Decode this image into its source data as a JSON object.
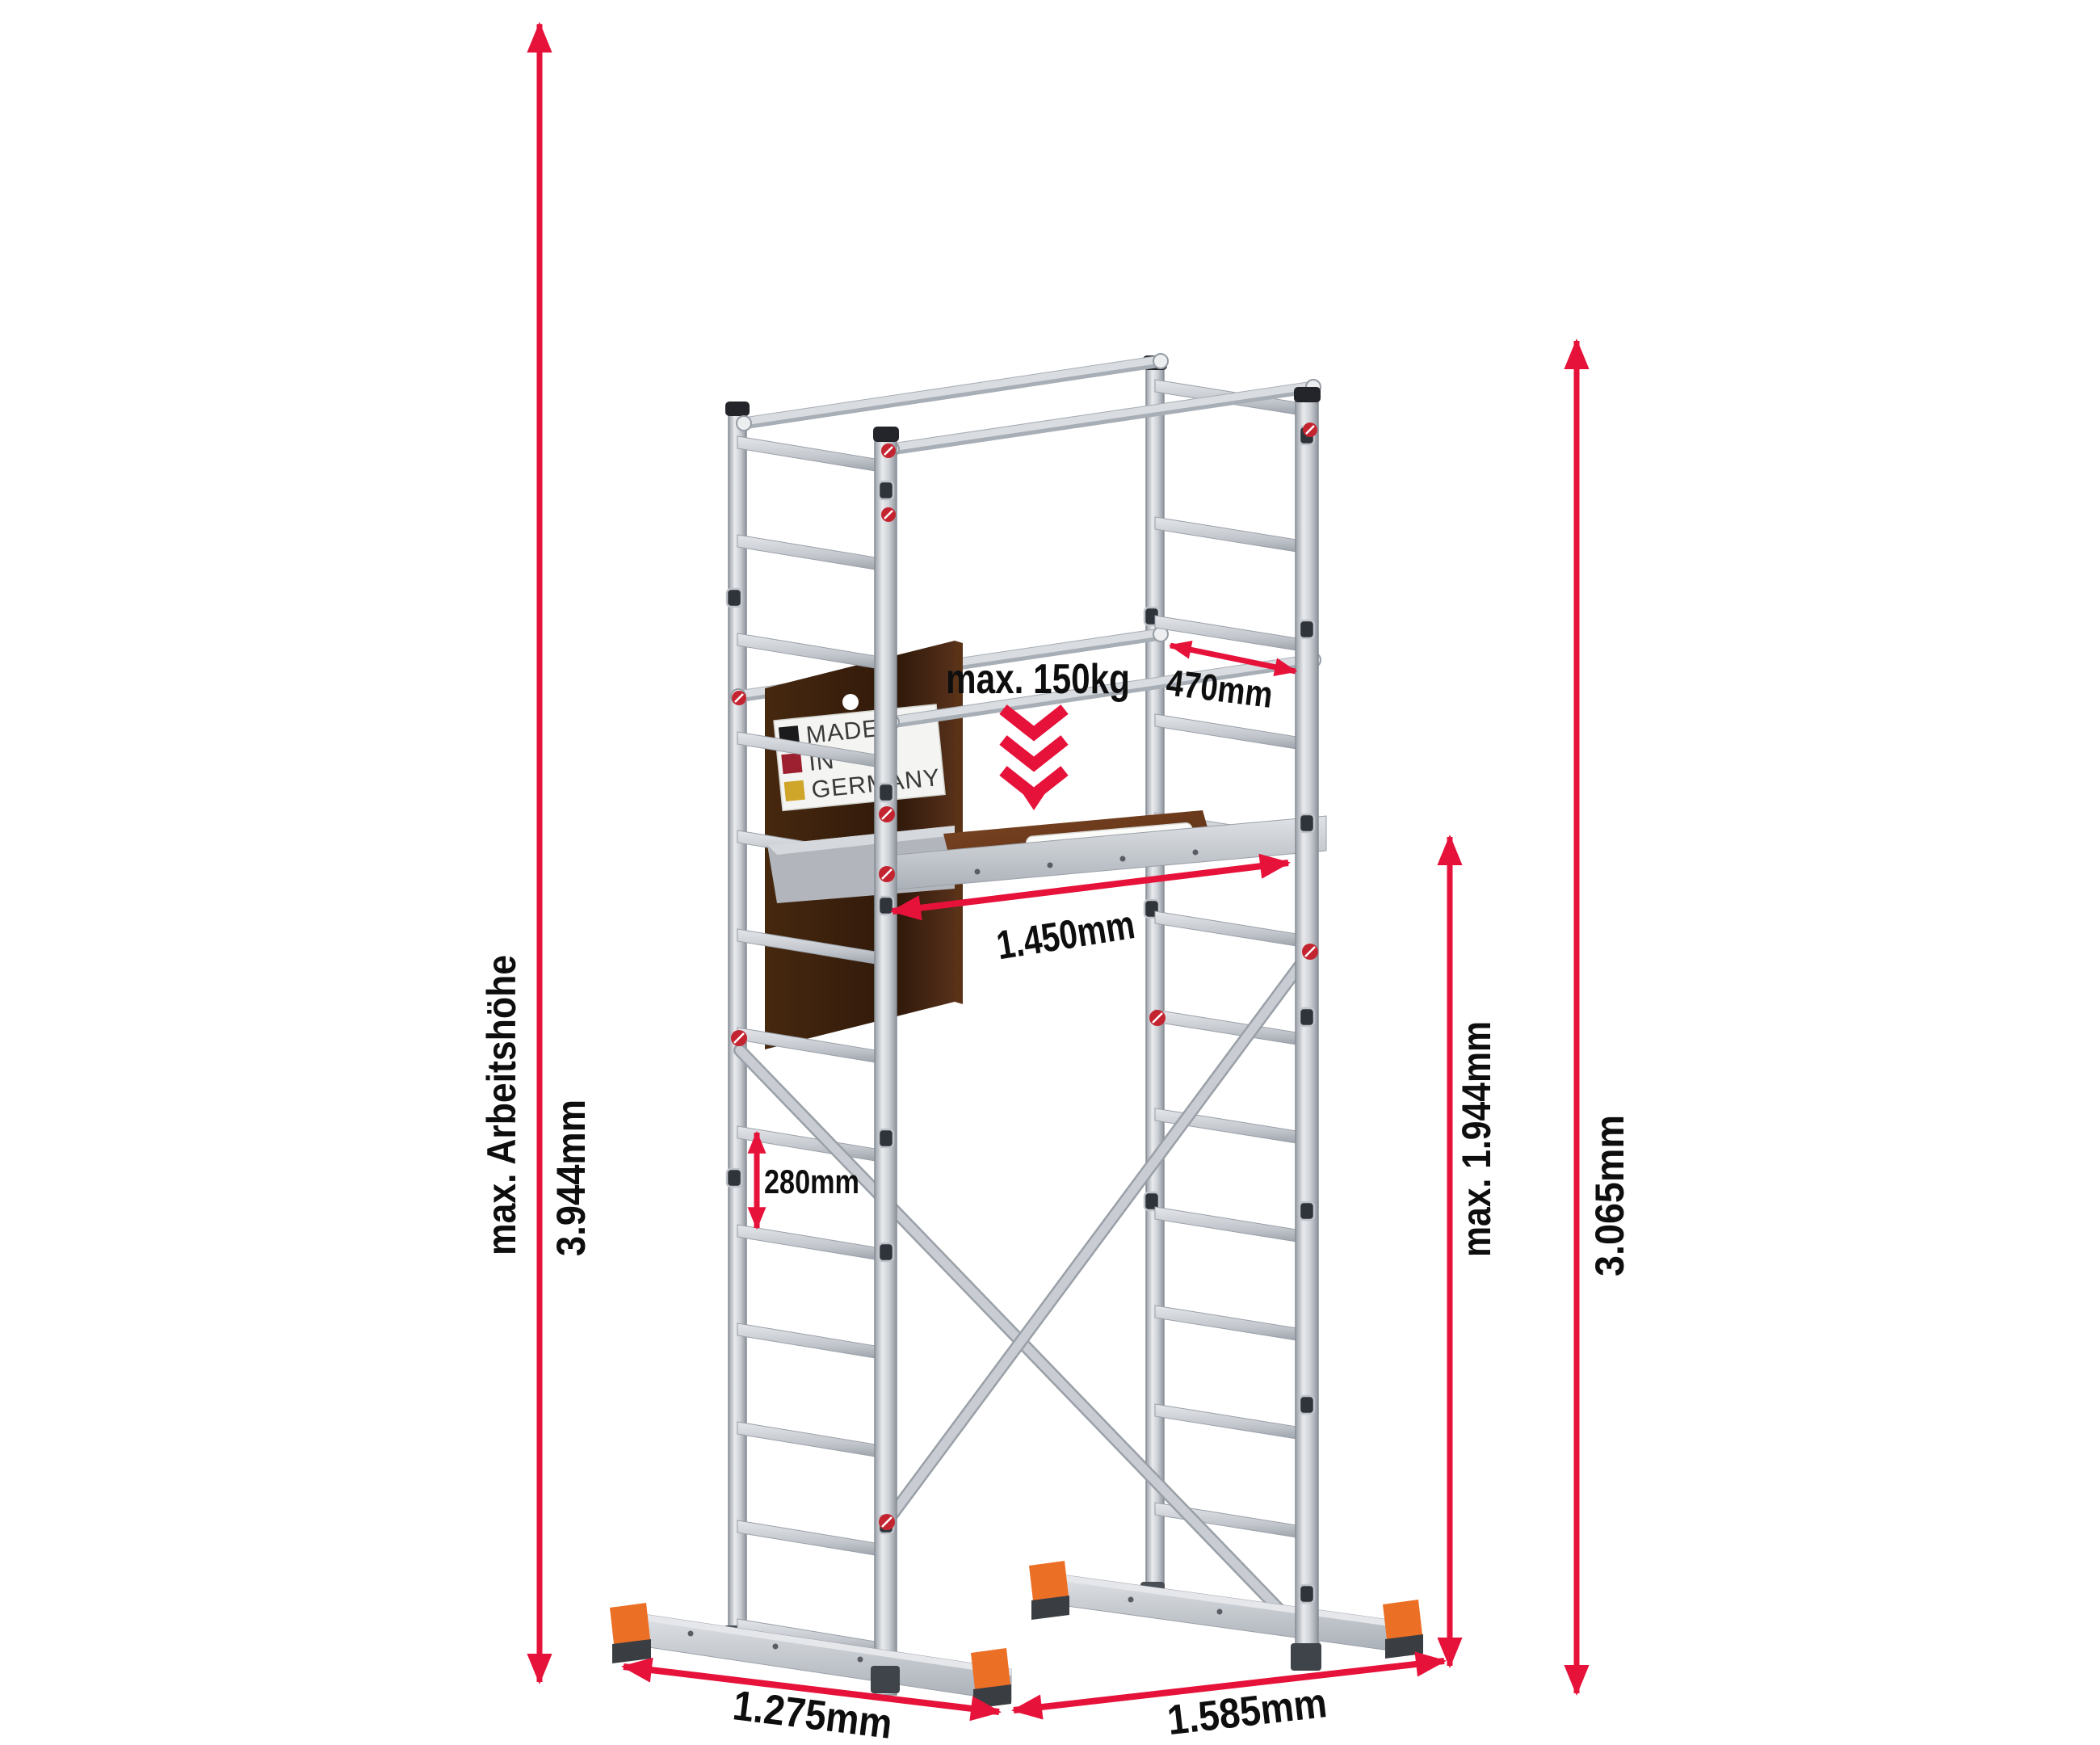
{
  "diagram": {
    "type": "product-dimension-diagram",
    "product": "aluminium-scaffold-tower",
    "dims": {
      "working_height": {
        "label": "max. Arbeitshöhe",
        "value": "3.944mm"
      },
      "scaffold_height": {
        "value": "3.065mm"
      },
      "platform_height": {
        "value": "max. 1.944mm"
      },
      "frame_width": {
        "value": "470mm"
      },
      "platform_length": {
        "value": "1.450mm"
      },
      "rung_spacing": {
        "value": "280mm"
      },
      "base_width_front": {
        "value": "1.275mm"
      },
      "base_width_side": {
        "value": "1.585mm"
      }
    },
    "load": {
      "max_label": "max. 150kg"
    },
    "sign": {
      "line1": "MADE",
      "line2": "IN",
      "line3": "GERMANY"
    },
    "platform": {
      "logo": "ALTEC"
    },
    "colors": {
      "dimension_red": "#e6123a",
      "clamp_red": "#c42430",
      "foot_orange": "#ec6f26",
      "board_brown": "#40240f",
      "deck_brown": "#6b3a1d",
      "aluminum_gray": "#c9cdd3",
      "flag_black": "#1b1b1d",
      "flag_red": "#9c2030",
      "flag_gold": "#cfa52a",
      "logo_red": "#c2232e"
    }
  }
}
